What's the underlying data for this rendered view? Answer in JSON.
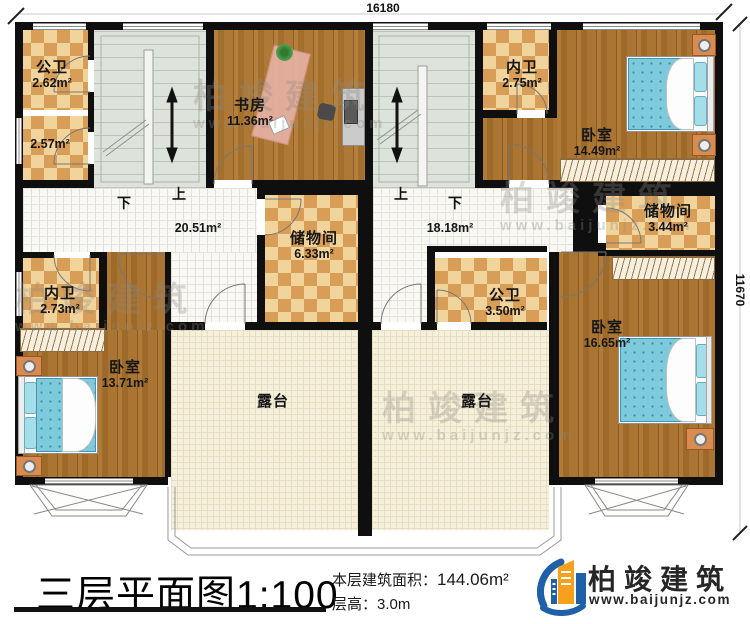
{
  "dimensions": {
    "top": "16180",
    "right": "11670"
  },
  "watermark": {
    "brand": "柏竣建筑",
    "site": "www.baijunjz.com"
  },
  "stair_labels": {
    "up": "上",
    "down": "下"
  },
  "rooms": {
    "gongwei_tl": {
      "name": "公卫",
      "area": "2.62m²"
    },
    "gongwei_tl2": {
      "area": "2.57m²"
    },
    "study": {
      "name": "书房",
      "area": "11.36m²"
    },
    "neiwei_tr": {
      "name": "内卫",
      "area": "2.75m²"
    },
    "bedroom_tr": {
      "name": "卧室",
      "area": "14.49m²"
    },
    "hall_left": {
      "area": "20.51m²"
    },
    "storage_left": {
      "name": "储物间",
      "area": "6.33m²"
    },
    "hall_right": {
      "area": "18.18m²"
    },
    "storage_right": {
      "name": "储物间",
      "area": "3.44m²"
    },
    "neiwei_bl": {
      "name": "内卫",
      "area": "2.73m²"
    },
    "gongwei_br": {
      "name": "公卫",
      "area": "3.50m²"
    },
    "bedroom_bl": {
      "name": "卧室",
      "area": "13.71m²"
    },
    "bedroom_br": {
      "name": "卧室",
      "area": "16.65m²"
    },
    "terrace_left": {
      "name": "露台"
    },
    "terrace_right": {
      "name": "露台"
    }
  },
  "titleblock": {
    "title": "三层平面图",
    "scale": "1:100",
    "area_label": "本层建筑面积：",
    "area_value": "144.06m²",
    "height_label": "层高：",
    "height_value": "3.0m"
  },
  "logo": {
    "brand": "柏竣建筑",
    "website": "www.baijunjz.com"
  }
}
